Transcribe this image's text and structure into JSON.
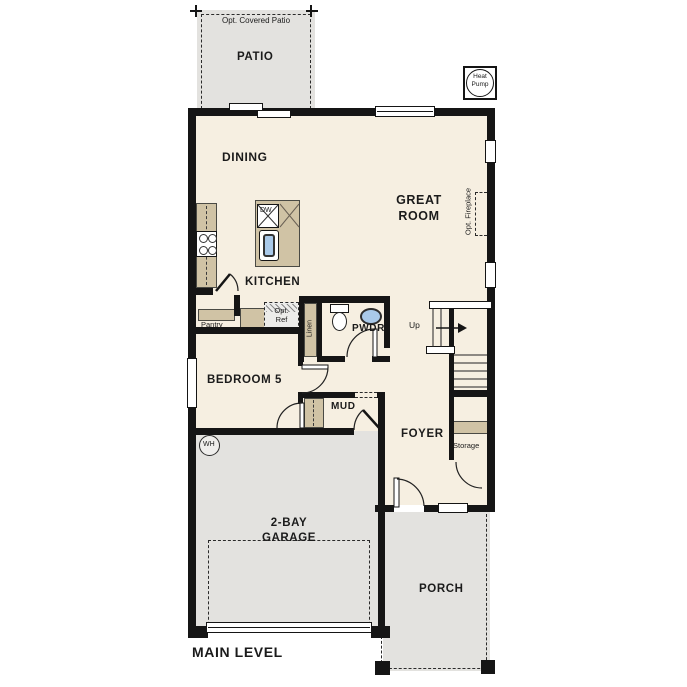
{
  "labels": {
    "opt_covered_patio": "Opt. Covered Patio",
    "patio": "PATIO",
    "heat_pump_line1": "Heat",
    "heat_pump_line2": "Pump",
    "dining": "DINING",
    "great_room_line1": "GREAT",
    "great_room_line2": "ROOM",
    "opt_fireplace": "Opt. Fireplace",
    "kitchen": "KITCHEN",
    "dishwasher": "DW",
    "pantry": "Pantry",
    "opt_ref_line1": "Opt.",
    "opt_ref_line2": "Ref",
    "linen": "Linen",
    "powder": "PWDR",
    "up": "Up",
    "bedroom5": "BEDROOM 5",
    "mud": "MUD",
    "foyer": "FOYER",
    "storage": "Storage",
    "water_heater": "WH",
    "garage_line1": "2-BAY",
    "garage_line2": "GARAGE",
    "porch": "PORCH",
    "main_level": "MAIN LEVEL"
  },
  "colors": {
    "wall": "#151515",
    "floor": "#f6efe1",
    "hardscape": "#e3e2df",
    "casework": "#d0c3a5",
    "fixture_blue": "#a9c9e9"
  }
}
